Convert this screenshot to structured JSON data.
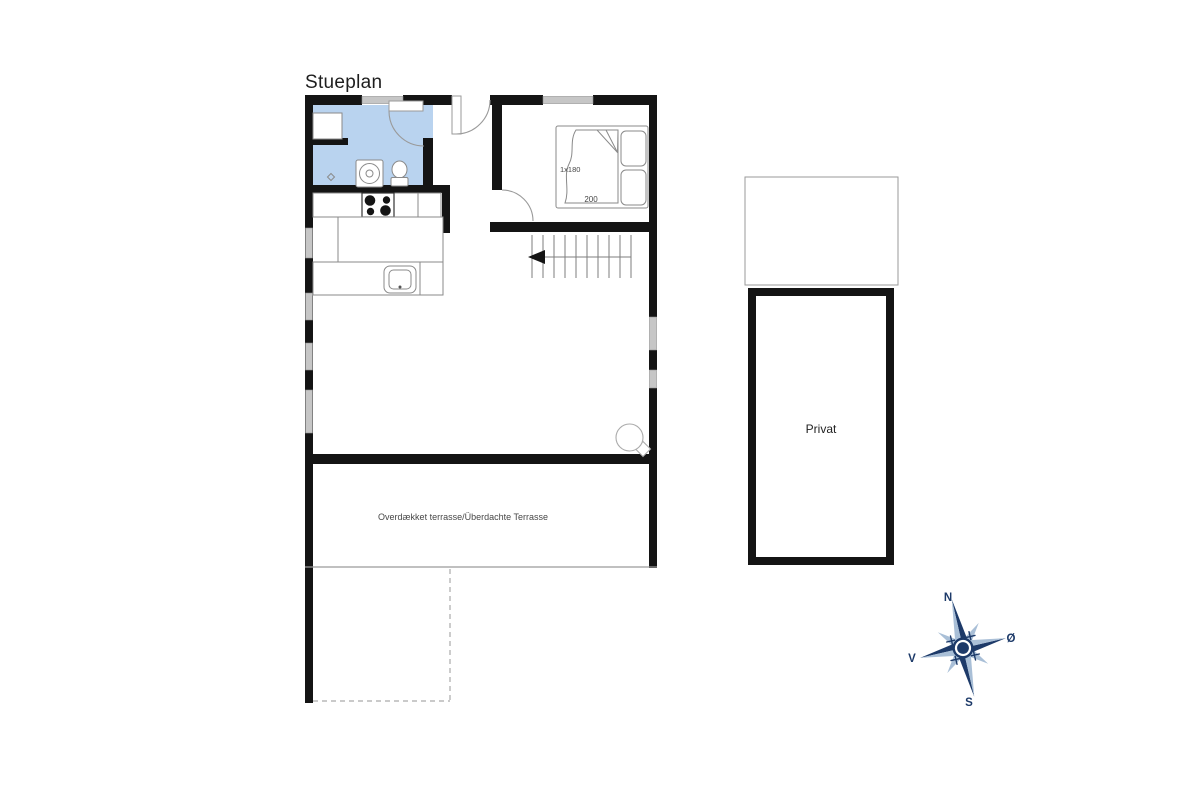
{
  "title": "Stueplan",
  "floorplan": {
    "bedroom": {
      "bed_width_label": "1x180",
      "bed_length_label": "200"
    },
    "terrace": {
      "label": "Overdækket terrasse/Überdachte Terrasse"
    },
    "outbuilding": {
      "label": "Privat"
    }
  },
  "compass": {
    "north": "N",
    "east": "Ø",
    "west": "V",
    "south": "S"
  },
  "colors": {
    "wall": "#141414",
    "window_fill": "#c6c6c6",
    "bathroom_fill": "#b9d3ef",
    "fixture_stroke": "#8a8a8a",
    "compass_dark": "#1d3a69",
    "compass_light": "#a9bfd7"
  }
}
